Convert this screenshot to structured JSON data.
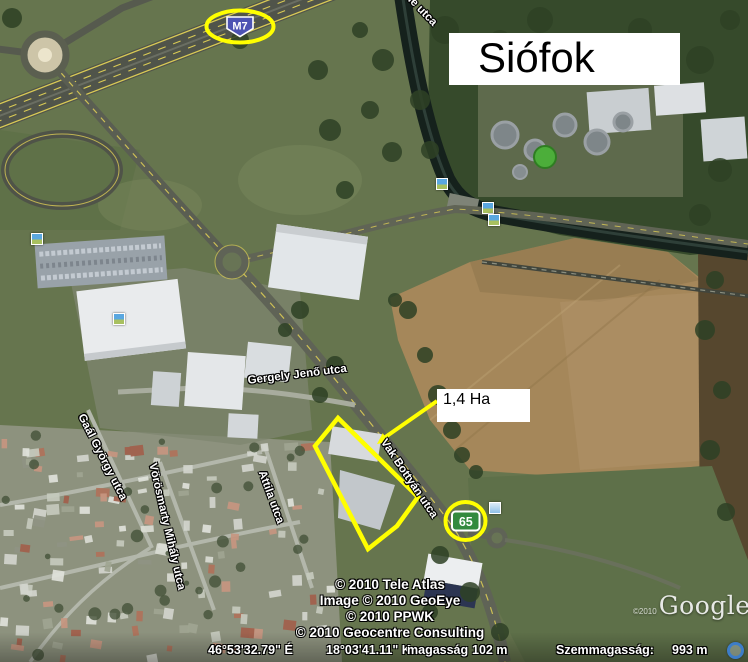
{
  "window": {
    "app": "Google Earth satellite view"
  },
  "title": "Siófok",
  "area_label": "1,4 Ha",
  "shields": {
    "m7": "M7",
    "r65": "65"
  },
  "streets": [
    {
      "id": "gergely-jeno-utca",
      "text": "Gergely Jenő utca"
    },
    {
      "id": "vak-bottyan-utca",
      "text": "Vak Bottyán utca"
    },
    {
      "id": "attila-utca",
      "text": "Attila utca"
    },
    {
      "id": "gaal-gyorgy-utca",
      "text": "Gaál György utca"
    },
    {
      "id": "vorosmarty-mihaly-utca",
      "text": "Vörösmarty Mihály utca"
    },
    {
      "id": "partial-street-top",
      "text": "le utca"
    }
  ],
  "copyright_lines": [
    "© 2010 Tele Atlas",
    "Image © 2010 GeoEye",
    "© 2010 PPWK",
    "© 2010 Geocentre Consulting"
  ],
  "status_bar": {
    "latitude": "46°53'32.79\" É",
    "longitude": "18°03'41.11\" K",
    "elevation_label": "magasság",
    "elevation_value": "102 m",
    "eye_altitude_label": "Szemmagasság:",
    "eye_altitude_value": "993 m"
  },
  "watermark": {
    "prefix": "©2010",
    "logo": "Google"
  },
  "icons": [
    "photo-marker-icon",
    "navigation-ring-icon"
  ],
  "colors": {
    "annotation_yellow": "#ffff00",
    "m7_shield_blue": "#4d53b3",
    "route65_green": "#338a3e",
    "road_paint_yellow": "#d9ca55"
  }
}
